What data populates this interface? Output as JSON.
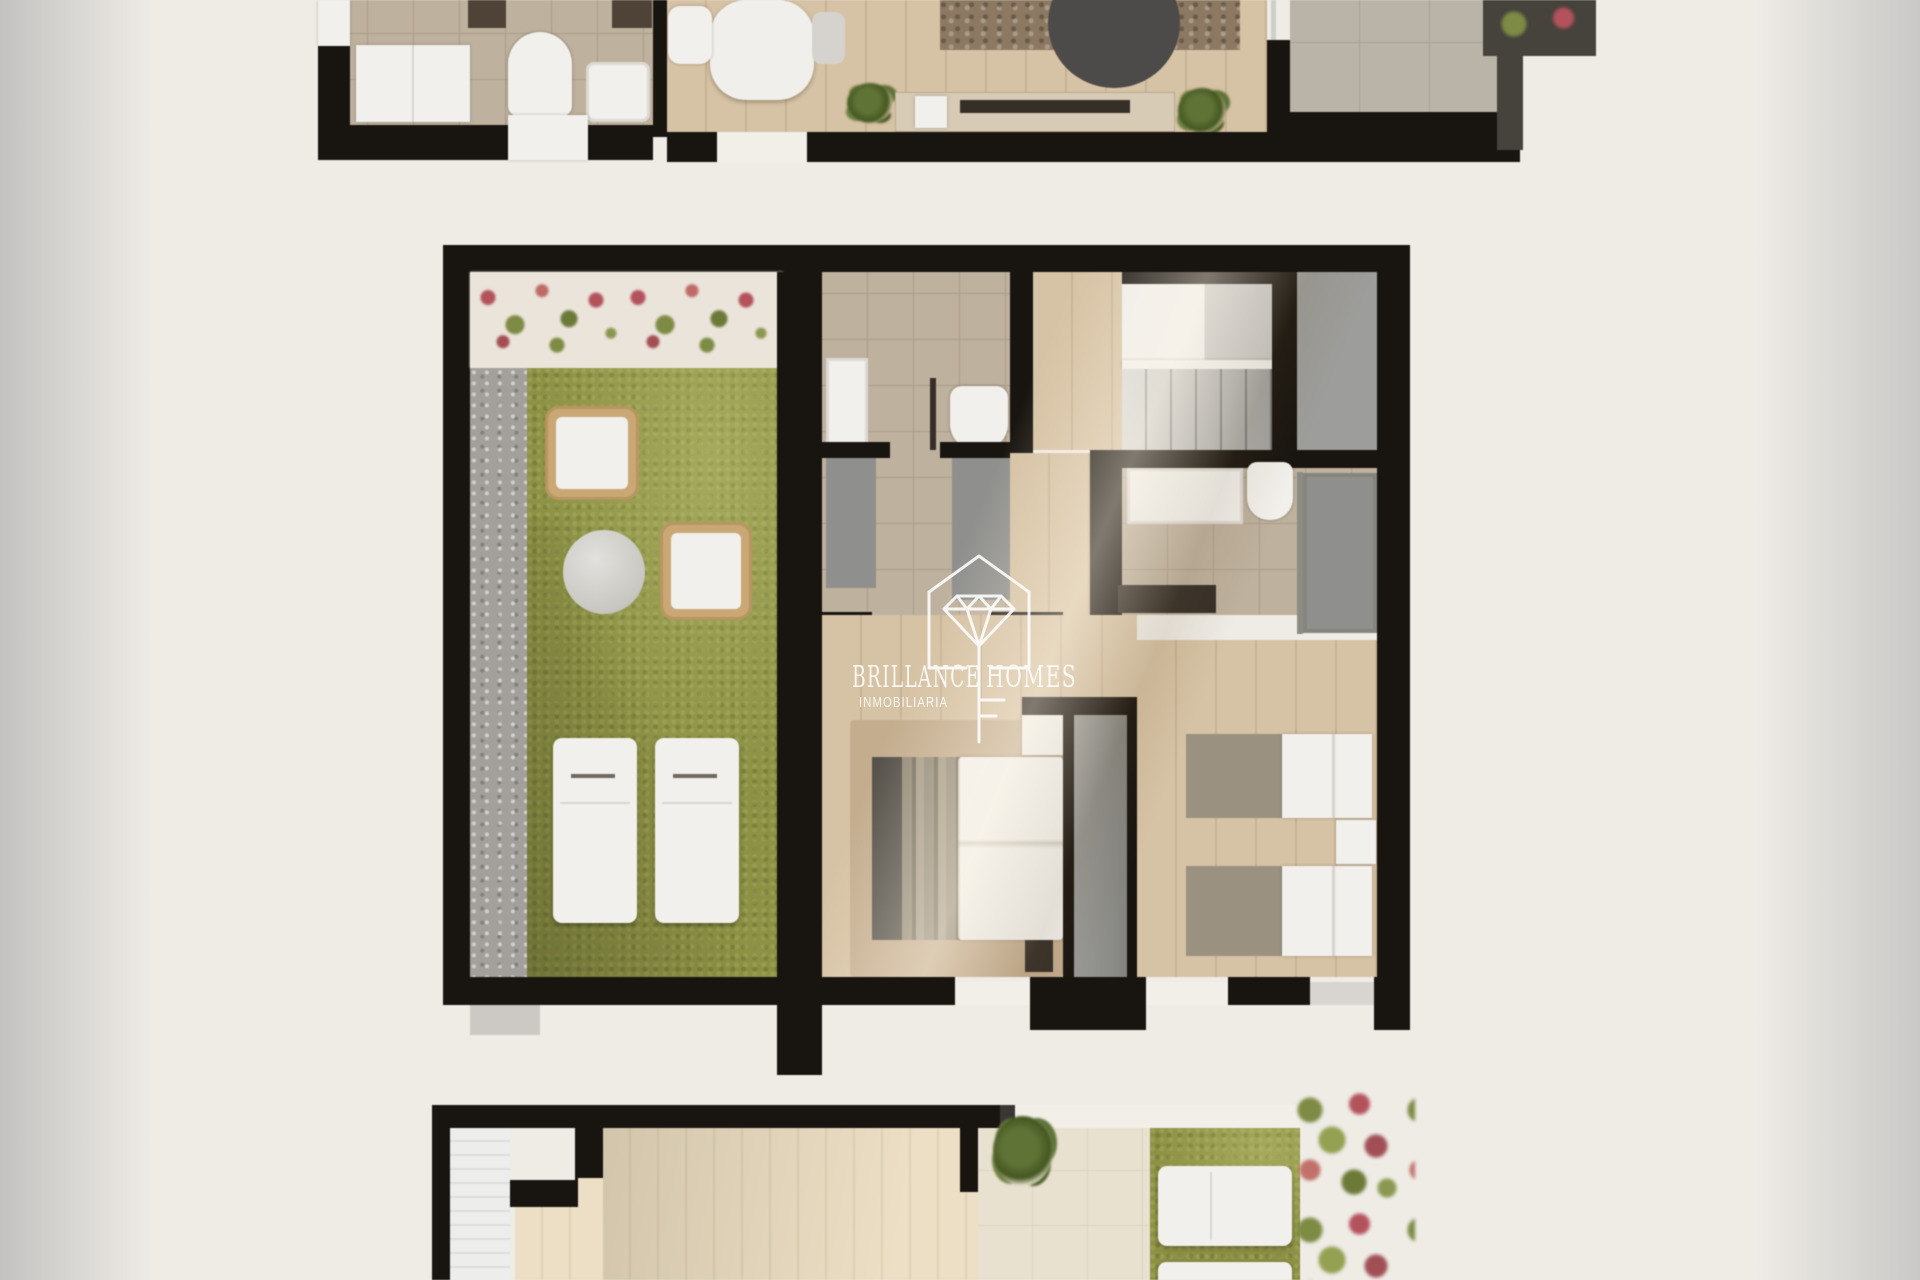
{
  "watermark": {
    "brand_left": "BRILLANCE",
    "brand_right": "HOMES",
    "subtitle": "INMOBILIARIA",
    "logo_icon": "diamond-house-key-icon"
  },
  "palette": {
    "canvas": "#efece6",
    "wall": "#18140f",
    "white": "#f2f0ec",
    "wood": "#d6c2a4",
    "woodline": "#c8b294",
    "deck": "#ecdfc5",
    "deckline": "#e0d2b2",
    "tile": "#beb19d",
    "tileline": "#aa9d89",
    "stone": "#b9b3a8",
    "stoneline": "#a8a094",
    "dtile": "#e9e1cf",
    "walk": "#f2efe8",
    "grass": "#8d9143",
    "gravel": "#a3a09b",
    "rug": "#c4ad8f",
    "rugtop": "#8d7962",
    "graydoor": "#8f8f8d",
    "landing": "#9d9d9b",
    "stairsl": "#d9d9d7",
    "stairsd": "#a2a2a0",
    "headboard": "#56524b",
    "blanket": "#9a9181",
    "dark": "#352f28",
    "marble": "#f1efec",
    "console": "#d7cbb5",
    "glass": "#cfcecb",
    "frame": "#46423c",
    "flowerbg": "#eae4da",
    "flred": "#b4525c",
    "flgreen": "#7d8b44",
    "wicker": "#c9a876"
  }
}
